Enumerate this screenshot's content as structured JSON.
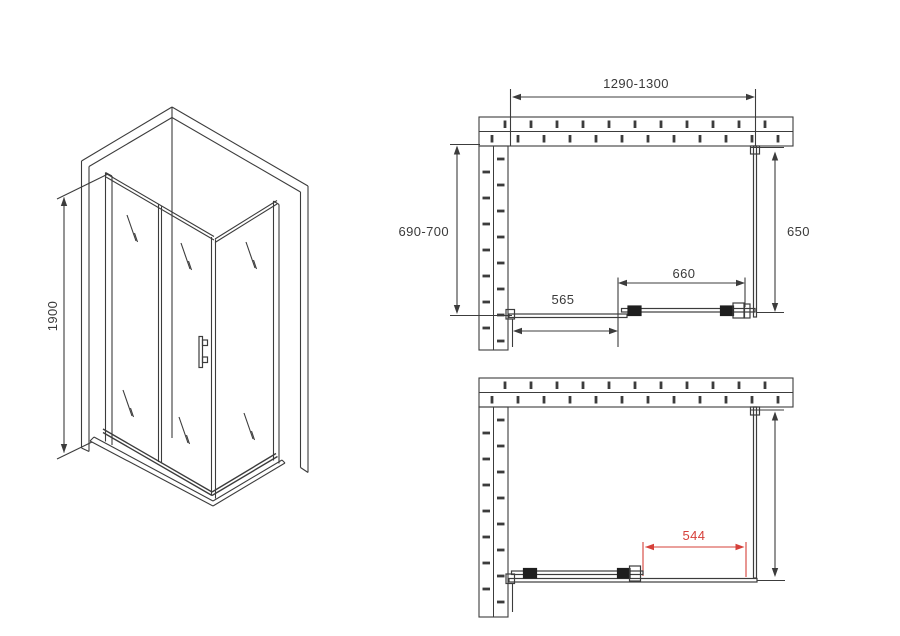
{
  "colors": {
    "line": "#3c3c3c",
    "dark": "#1e1e1e",
    "text": "#3a3a3a",
    "dim_red": "#d6403a"
  },
  "isometric_view": {
    "height_mm": "1900"
  },
  "plan_view_top": {
    "overall_width_mm": "1290-1300",
    "side_depth_mm": "690-700",
    "side_glass_mm": "650",
    "door_width_mm": "660",
    "fixed_panel_mm": "565"
  },
  "plan_view_bottom": {
    "open_passage_mm": "544"
  }
}
